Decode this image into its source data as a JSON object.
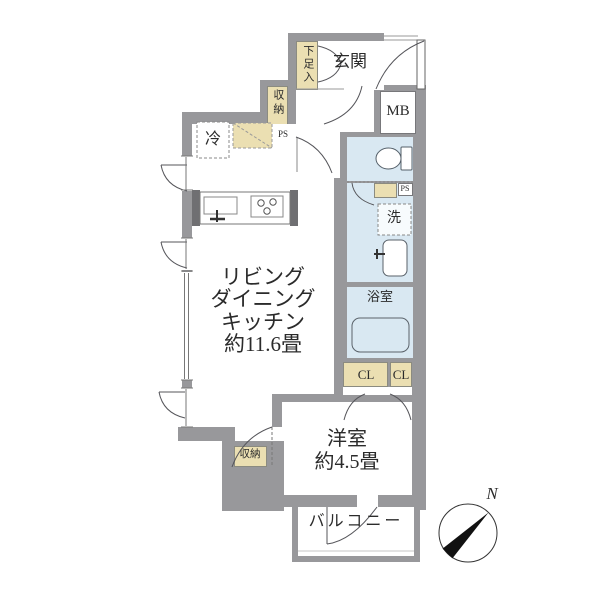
{
  "title": "apartment-floorplan",
  "labels": {
    "entrance": "玄関",
    "shoe_cabinet": "下足入",
    "meter_box": "MB",
    "storage_upper": "収納",
    "pipe_space_upper": "PS",
    "refrigerator": "冷",
    "washer": "洗",
    "pipe_space_mid": "PS",
    "bathroom": "浴室",
    "closet_left": "CL",
    "closet_right": "CL",
    "ldk_line1": "リビング",
    "ldk_line2": "ダイニング",
    "ldk_line3": "キッチン",
    "ldk_size": "約11.6畳",
    "western_room": "洋室",
    "western_room_size": "約4.5畳",
    "storage_lower": "収納",
    "balcony": "バルコニー",
    "compass_north": "N"
  },
  "colors": {
    "wall": "#98989b",
    "water_room": "#d9e8f2",
    "storage_fill": "#ebdfb2",
    "line": "#55555a",
    "text": "#2b2b2b"
  }
}
